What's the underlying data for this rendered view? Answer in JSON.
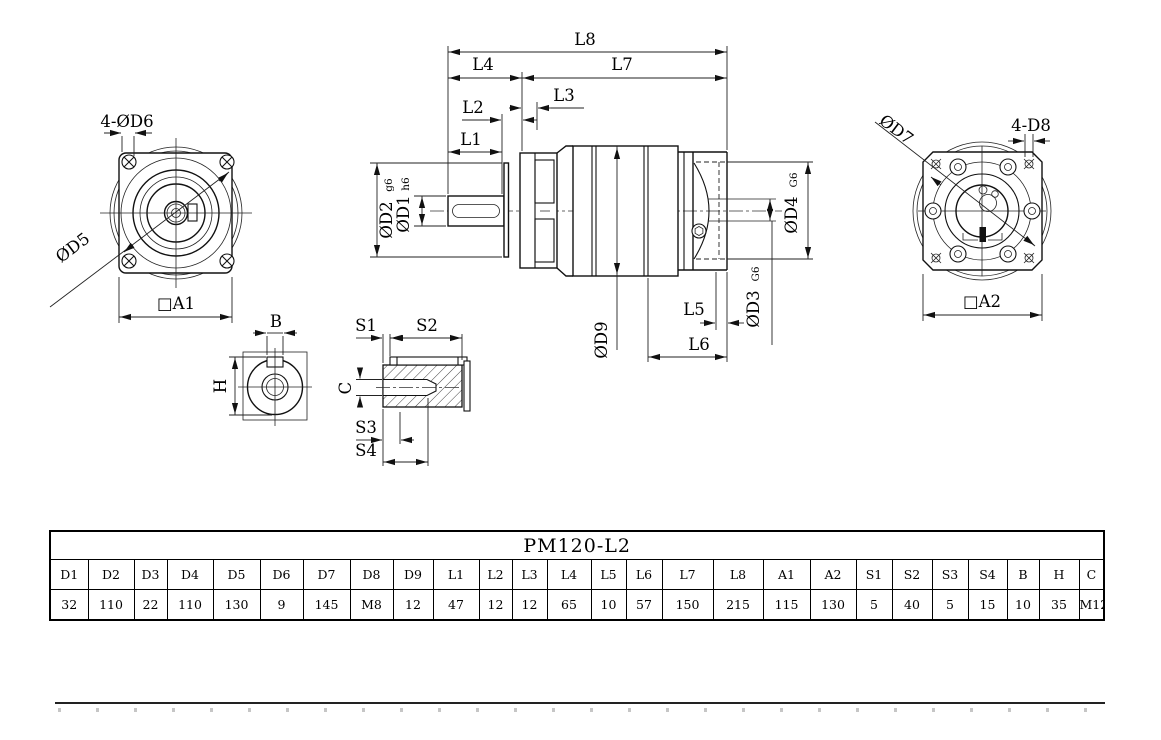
{
  "drawing": {
    "front_view": {
      "bolt_holes_label": "4-ØD6",
      "bolt_circle_label": "ØD5",
      "square_label": "□A1"
    },
    "side_view": {
      "l1": "L1",
      "l2": "L2",
      "l3": "L3",
      "l4": "L4",
      "l5": "L5",
      "l6": "L6",
      "l7": "L7",
      "l8": "L8",
      "d1": "ØD1",
      "d1_tol": "h6",
      "d2": "ØD2",
      "d2_tol": "g6",
      "d3": "ØD3",
      "d3_tol": "G6",
      "d4": "ØD4",
      "d4_tol": "G6",
      "d9": "ØD9"
    },
    "back_view": {
      "bolt_circle_label": "ØD7",
      "tap_holes_label": "4-D8",
      "square_label": "□A2"
    },
    "shaft_section_view": {
      "width_label": "B",
      "height_label": "H"
    },
    "key_view": {
      "s1": "S1",
      "s2": "S2",
      "s3": "S3",
      "s4": "S4",
      "c": "C"
    }
  },
  "table": {
    "title": "PM120-L2",
    "headers": [
      "D1",
      "D2",
      "D3",
      "D4",
      "D5",
      "D6",
      "D7",
      "D8",
      "D9",
      "L1",
      "L2",
      "L3",
      "L4",
      "L5",
      "L6",
      "L7",
      "L8",
      "A1",
      "A2",
      "S1",
      "S2",
      "S3",
      "S4",
      "B",
      "H",
      "C"
    ],
    "values": [
      "32",
      "110",
      "22",
      "110",
      "130",
      "9",
      "145",
      "M8",
      "12",
      "47",
      "12",
      "12",
      "65",
      "10",
      "57",
      "150",
      "215",
      "115",
      "130",
      "5",
      "40",
      "5",
      "15",
      "10",
      "35",
      "M12"
    ]
  }
}
